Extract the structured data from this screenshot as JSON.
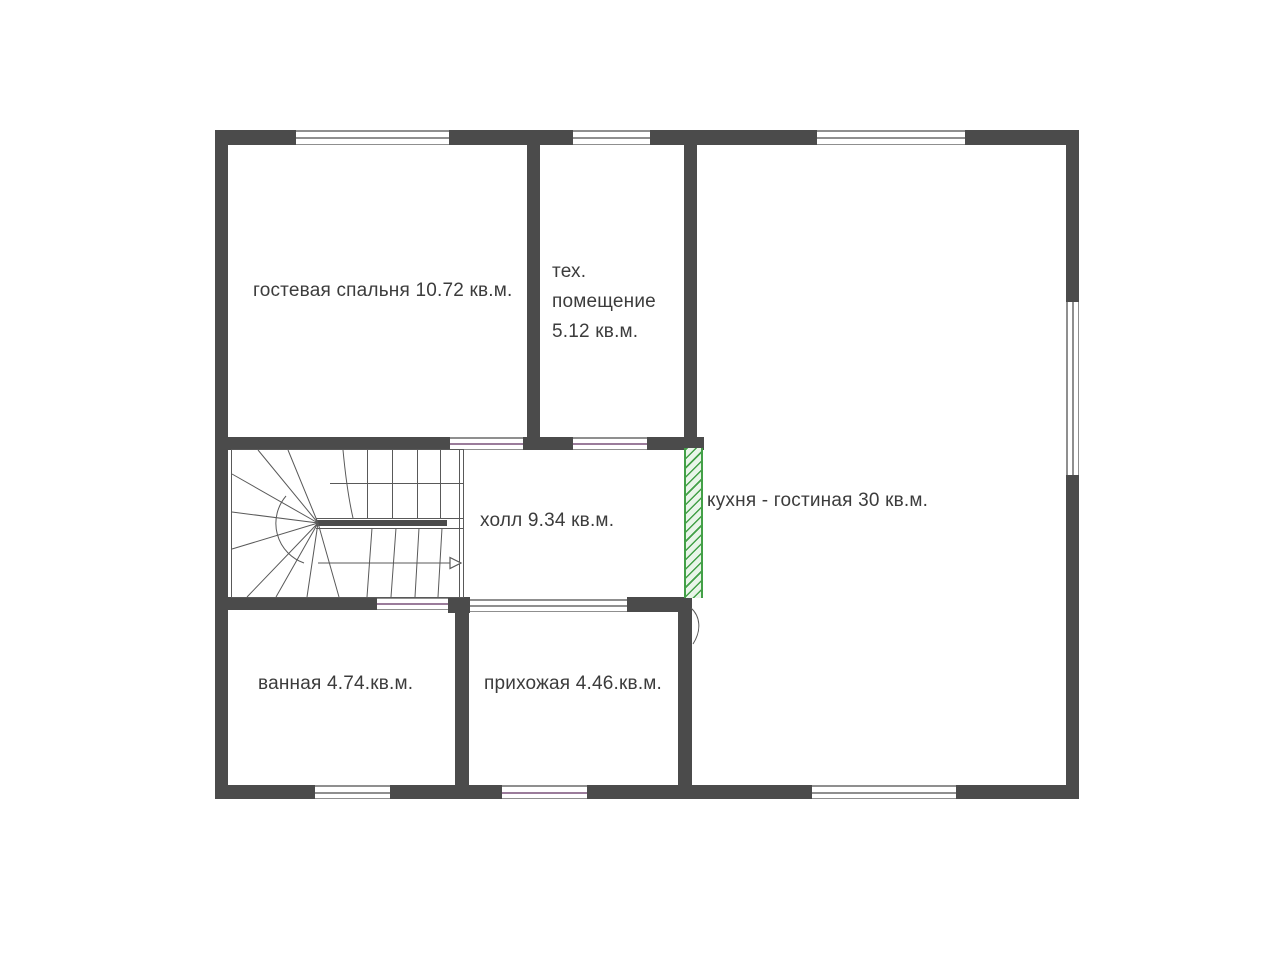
{
  "plan": {
    "rooms": [
      {
        "name": "guest-bedroom",
        "label": "гостевая спальня 10.72 кв.м."
      },
      {
        "name": "tech-room",
        "lines": [
          "тех.",
          "помещение",
          "5.12 кв.м."
        ]
      },
      {
        "name": "kitchen-living-room",
        "label": "кухня - гостиная 30 кв.м."
      },
      {
        "name": "hall",
        "label": "холл 9.34 кв.м."
      },
      {
        "name": "bathroom",
        "label": "ванная 4.74.кв.м."
      },
      {
        "name": "entry-hall",
        "label": "прихожая 4.46.кв.м."
      }
    ],
    "icons": {
      "stair_direction_arrow": "▷"
    }
  },
  "colors": {
    "wall": "#4b4b4b",
    "stair_line": "#595959",
    "window_line": "#8f8f8f",
    "opening_accent": "#9b7c9b",
    "hatch_green": "#43a047",
    "hatch_fill": "#e9f5e9",
    "text": "#3c3c3c"
  }
}
